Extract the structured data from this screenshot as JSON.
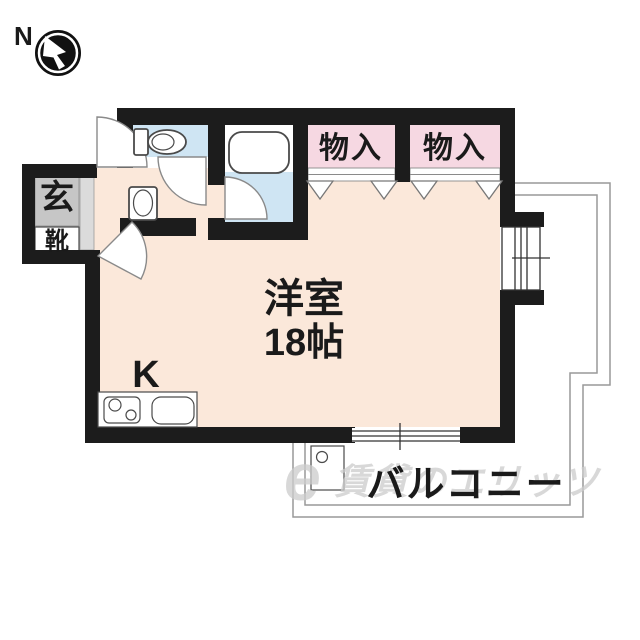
{
  "compass": {
    "north_label": "N"
  },
  "plan": {
    "entrance": {
      "room_label": "玄",
      "shoe_cabinet_label": "靴"
    },
    "storage_closets": [
      {
        "label": "物入"
      },
      {
        "label": "物入"
      }
    ],
    "main_room": {
      "name_line": "洋室",
      "size_line": "18帖"
    },
    "kitchen": {
      "label": "K"
    },
    "balcony": {
      "label": "バルコニー"
    }
  },
  "watermark": {
    "logo": "e",
    "text": "賃貸のエリッツ"
  },
  "colors": {
    "wall": "#1c1c1c",
    "floor": "#fbe8da",
    "wet_area": "#cfe5f3",
    "closet": "#f6d8e2",
    "entrance_tile": "#c6c6c6"
  }
}
